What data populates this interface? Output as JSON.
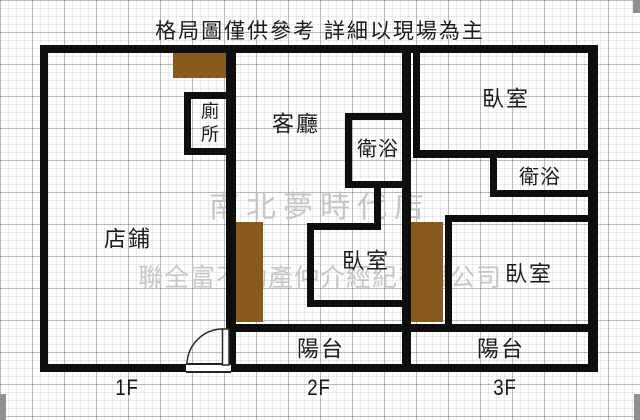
{
  "title": "格局圖僅供參考 詳細以現場為主",
  "watermarks": {
    "store": "南北夢時代店",
    "company": "聯全富不動產仲介經紀有限公司"
  },
  "floor_labels": {
    "f1": "1F",
    "f2": "2F",
    "f3": "3F"
  },
  "rooms": {
    "f1_shop": "店鋪",
    "f1_toilet": "廁所",
    "f2_living_room": "客廳",
    "f2_bathroom": "衛浴",
    "f2_bedroom": "臥室",
    "f2_balcony": "陽台",
    "f3_bedroom_upper": "臥室",
    "f3_bathroom": "衛浴",
    "f3_bedroom_lower": "臥室",
    "f3_balcony": "陽台"
  },
  "colors": {
    "wall": "#0e0e0e",
    "stair_block": "#8a5a1c",
    "watermark_text": "#c3c3c3",
    "grid_minor": "#e4e4e4",
    "grid_major": "#c9c9c9"
  }
}
